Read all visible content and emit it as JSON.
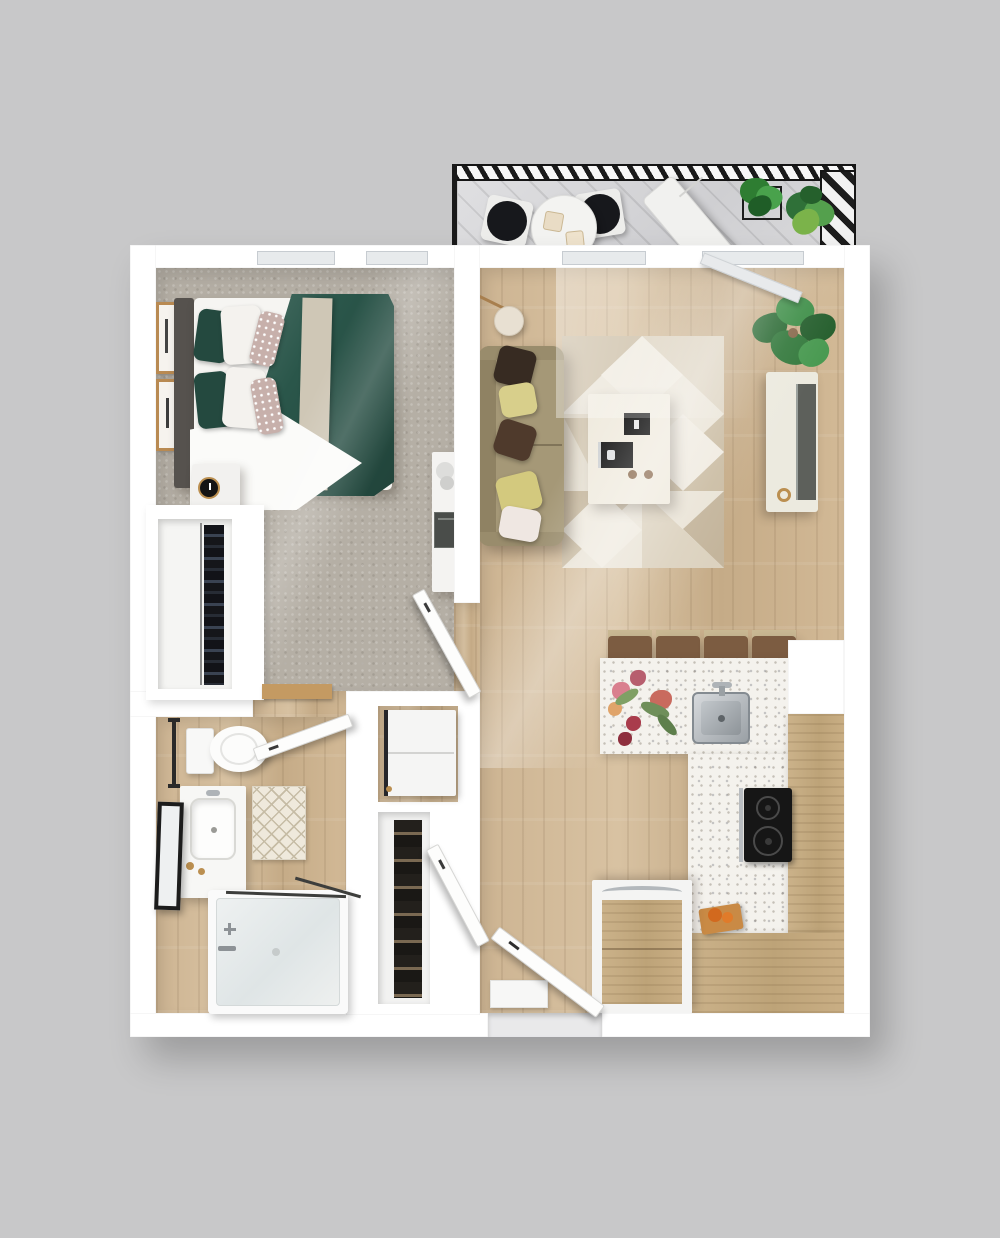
{
  "scene": {
    "kind": "3d-floor-plan-top-down-render",
    "unit": "one-bedroom-one-bath-apartment-with-balcony"
  },
  "colors": {
    "background": "#c8c8c9",
    "wall": "#ffffff",
    "carpet": "#b5afa5",
    "counter_terrazzo": "#f4f2ed",
    "duvet_green": "#2a564a",
    "pillow_green": "#24493f",
    "couch_tan": "#a59877",
    "rug_base": "#eae4d7",
    "rug_triangle": "#cbbda4",
    "rug_triangle_light": "#dcd2bf",
    "cooktop_black": "#161616",
    "tv_gray": "#5d605b",
    "plant_green": "#2f7038",
    "brass": "#bb8f50",
    "stainless": "#aeb3b7",
    "railing_black": "#1a1a1a",
    "headboard_gray": "#56524e",
    "wood_tone": "#ccb492"
  },
  "rooms": [
    {
      "id": "balcony",
      "items": [
        "railing",
        "deck",
        "bistro-table",
        "bistro-chair",
        "bistro-chair",
        "coffee-mug",
        "coffee-mug",
        "lounge-chair",
        "potted-plant",
        "potted-plant",
        "corner-hatch-screen"
      ]
    },
    {
      "id": "bedroom",
      "items": [
        "window",
        "window",
        "bed",
        "headboard",
        "green-duvet",
        "white-sheet",
        "throw-blanket",
        "pillows",
        "nightstand",
        "alarm-clock",
        "wall-art-frame",
        "wall-art-frame",
        "closet",
        "hanging-clothes",
        "desk",
        "laptop",
        "bedroom-door"
      ]
    },
    {
      "id": "bathroom",
      "items": [
        "toilet",
        "towel-bar",
        "vanity",
        "sink",
        "leaning-mirror",
        "bath-mat",
        "bathtub",
        "glass-panel",
        "tub-faucet",
        "bathroom-door",
        "threshold-mat"
      ]
    },
    {
      "id": "utility",
      "items": [
        "washer-dryer",
        "linen-closet-shelves",
        "linen-closet-door"
      ]
    },
    {
      "id": "living_room",
      "items": [
        "balcony-window",
        "balcony-glass-door",
        "sofa",
        "throw-pillows",
        "floor-lamp",
        "area-rug",
        "coffee-table",
        "books",
        "tv-console",
        "tv-screen",
        "houseplant",
        "sunbeam"
      ]
    },
    {
      "id": "kitchen",
      "items": [
        "peninsula-counter",
        "kitchen-sink",
        "faucet",
        "flower-arrangement",
        "bar-stool",
        "bar-stool",
        "bar-stool",
        "bar-stool",
        "cooktop",
        "upper-cabinets",
        "lower-cabinets",
        "cutting-board",
        "refrigerator"
      ]
    },
    {
      "id": "entry",
      "items": [
        "entry-door",
        "door-mat",
        "threshold"
      ]
    }
  ]
}
